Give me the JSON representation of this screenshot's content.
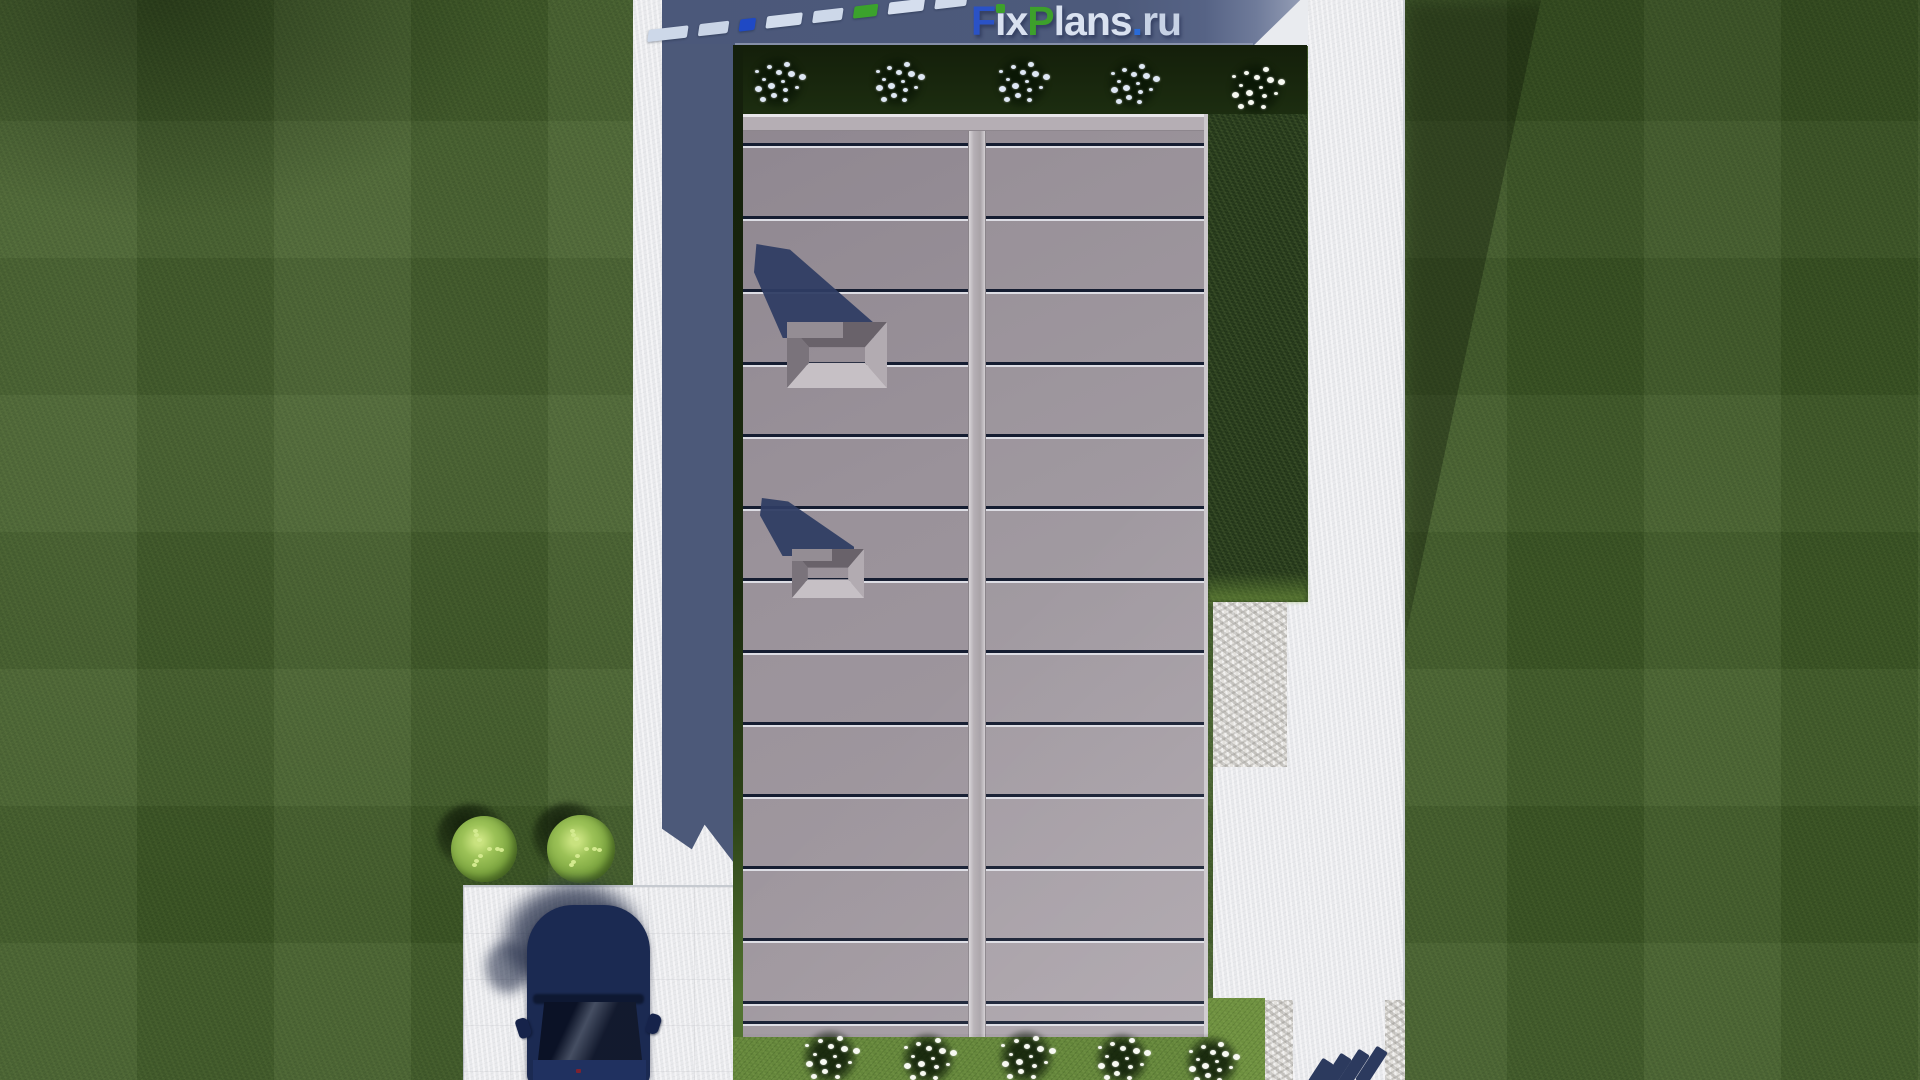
{
  "watermark": {
    "text": "FixPlans.ru",
    "parts": [
      {
        "text": "F",
        "color": "#2a52c6"
      },
      {
        "text": "i",
        "display": "ı",
        "color": "#d9e1f0",
        "dot_color": "#3da02b"
      },
      {
        "text": "x",
        "color": "#d9e1f0"
      },
      {
        "text": "P",
        "color": "#3da02b"
      },
      {
        "text": "lans",
        "color": "#d9e1f0"
      },
      {
        "text": ".",
        "color": "#2a6bd8"
      },
      {
        "text": "ru",
        "color": "#c7d2e5"
      }
    ]
  },
  "scene": {
    "description": "Top-down 3D architectural render of a rectangular flat-roof house on a lawn: standing-seam grey roof with two skylights, concrete walkways, stone patio, garden beds with white flowering shrubs, parking pad with a dark blue car, and dashed site-boundary markings.",
    "objects": [
      "lawn",
      "house roof",
      "roof ridge",
      "skylights",
      "left walkway",
      "right walkway",
      "stone patio",
      "parking pad",
      "dark blue car",
      "green bushes",
      "white flower clusters",
      "boundary dashes",
      "FixPlans.ru watermark"
    ]
  },
  "colors": {
    "grass_base": "#3c5626",
    "grass_sunlit": "#668a3c",
    "bed_dark": "#18270d",
    "pavement": "#e8e9ec",
    "pavement_shadow": "#4d5a7b",
    "stone": "#e3e1dd",
    "roof_gray": "#9a929a",
    "roof_light": "#aba3aa",
    "seam_dark": "#151d31",
    "seam_light": "#dddde4",
    "shadow_navy": "#2f3d63",
    "car_navy": "#1b2a52",
    "car_glass": "#0b1226",
    "flower_pale": "#dee7f4",
    "flower_white": "#f7f9f2",
    "bush_green": "#8fb84e",
    "marking_pale": "#cdd8e9",
    "marking_blue": "#1f49c4",
    "marking_green": "#3ba22c",
    "marking_navy": "#2c3a5e"
  },
  "roof": {
    "left": 743,
    "top": 114,
    "right": 1208,
    "bottom": 1037,
    "ridge_left": 968,
    "ridge_right": 986,
    "cap_height": 17,
    "seam_ys": [
      143,
      216,
      289,
      362,
      434,
      506,
      578,
      650,
      722,
      794,
      866,
      938,
      1001,
      1021
    ]
  },
  "skylights": [
    {
      "pyramid": {
        "x": 787,
        "y": 322,
        "w": 100,
        "h": 66
      },
      "shadow": {
        "x": 754,
        "y": 244,
        "w": 120,
        "h": 94
      }
    },
    {
      "pyramid": {
        "x": 792,
        "y": 549,
        "w": 72,
        "h": 49
      },
      "shadow": {
        "x": 760,
        "y": 498,
        "w": 94,
        "h": 58
      }
    }
  ],
  "garden": {
    "flower_clusters_top": [
      {
        "x": 778,
        "y": 82,
        "s": 58,
        "tone": "pale"
      },
      {
        "x": 898,
        "y": 82,
        "s": 56,
        "tone": "pale"
      },
      {
        "x": 1022,
        "y": 82,
        "s": 58,
        "tone": "pale"
      },
      {
        "x": 1133,
        "y": 84,
        "s": 56,
        "tone": "pale"
      },
      {
        "x": 1256,
        "y": 88,
        "s": 60,
        "tone": "bright"
      }
    ],
    "flower_clusters_bottom": [
      {
        "x": 830,
        "y": 1057,
        "s": 62,
        "tone": "bright"
      },
      {
        "x": 928,
        "y": 1059,
        "s": 60,
        "tone": "bright"
      },
      {
        "x": 1026,
        "y": 1057,
        "s": 62,
        "tone": "bright"
      },
      {
        "x": 1122,
        "y": 1059,
        "s": 60,
        "tone": "bright"
      },
      {
        "x": 1212,
        "y": 1062,
        "s": 58,
        "tone": "bright"
      }
    ],
    "bushes": [
      {
        "x": 484,
        "y": 849,
        "r": 33
      },
      {
        "x": 581,
        "y": 849,
        "r": 34
      }
    ]
  },
  "markings": {
    "top_line": {
      "x": 648,
      "y": 30,
      "angle_deg": -6.5,
      "dash_h": 12,
      "gap": 11,
      "dashes": [
        {
          "w": 40,
          "color": "#cdd8e9"
        },
        {
          "w": 30,
          "color": "#c9d4e6"
        },
        {
          "w": 16,
          "color": "#1f49c4"
        },
        {
          "w": 36,
          "color": "#d2dcec"
        },
        {
          "w": 30,
          "color": "#cdd8e9"
        },
        {
          "w": 24,
          "color": "#3ba22c"
        },
        {
          "w": 36,
          "color": "#d5deee"
        },
        {
          "w": 32,
          "color": "#d0daea"
        }
      ]
    },
    "bottom_line": {
      "w": 13,
      "h": 40,
      "angle_deg": 33,
      "color": "#2c3a5e",
      "dashes": [
        {
          "x": 1311,
          "y": 1058
        },
        {
          "x": 1329,
          "y": 1053
        },
        {
          "x": 1347,
          "y": 1049
        },
        {
          "x": 1365,
          "y": 1046
        }
      ]
    }
  },
  "car": {
    "x": 527,
    "y": 905,
    "w": 123,
    "body_color": "#1b2a52",
    "glass_color": "#0b1226",
    "mirrors": 2,
    "heading": "front-up"
  }
}
